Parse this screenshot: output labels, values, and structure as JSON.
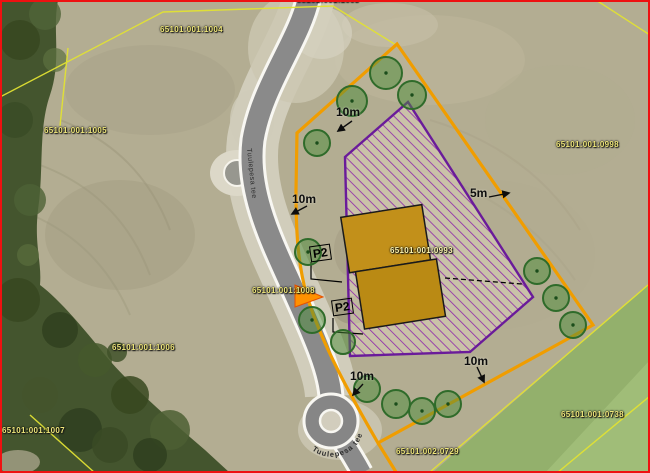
{
  "map_type": "cadastral-aerial-detail-plan",
  "labels": {
    "parcels": {
      "top_clipped": "65101:001:1003",
      "nw": "65101:001:1004",
      "west": "65101:001:1005",
      "east": "65101:001:0998",
      "site": "65101:001:0993",
      "road": "65101:001:1008",
      "sw_upper": "65101:001:1006",
      "sw_lower": "65101:001:1007",
      "se_green": "65101:001:0738",
      "se_edge": "65101:002:0729"
    },
    "dims": {
      "top": "10m",
      "left": "10m",
      "right": "5m",
      "bottom_left": "10m",
      "bottom_right": "10m"
    },
    "parking": {
      "p1": "P2",
      "p2": "P2"
    }
  },
  "roads": {
    "name": "Tuulepesa tee",
    "roundabout_name": "Tuulepesa tee"
  },
  "colors": {
    "frame": "#ee1111",
    "cadastral_line": "#e2e233",
    "parcel_boundary": "#f09d00",
    "building_envelope": "#6a1b9a",
    "envelope_hatch": "#8e24aa",
    "building_fill": "#c2901a",
    "tree_stroke": "#2f6b2a",
    "highlight_arrow": "#ff9100",
    "road_fill": "#8a8a8a",
    "forest": "#44552e",
    "field_green": "#93b06c",
    "parcel_label_text": "#efe77c"
  }
}
